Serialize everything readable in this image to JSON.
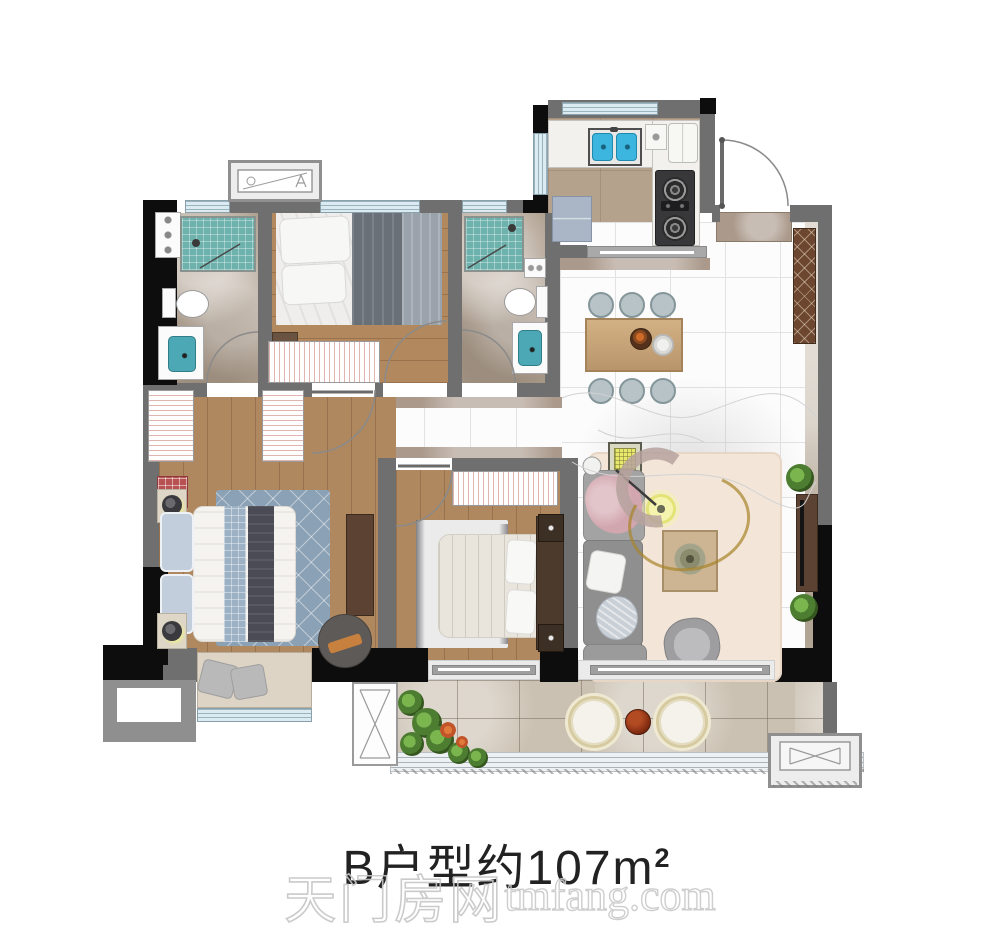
{
  "title": {
    "text": "B户型约107m",
    "sup": "2"
  },
  "watermark": {
    "cn": "天门房网",
    "en": "tmfang.com"
  },
  "palette": {
    "wall_gray": "#6f6f6f",
    "wall_black": "#0d0d0d",
    "window_blue": "#dcebf1",
    "window_line": "#9ab4be",
    "wood_floor": "#b0885f",
    "bath_marble": "#b0a191",
    "white_tile": "#fcfcfc",
    "balcony_tile": "#cbc1b2",
    "shower_teal": "#6db2ac",
    "fixture_teal": "#4ba8b4",
    "kitchen_sink_blue": "#3cb6de",
    "dining_wood": "#b9956b",
    "cabinet_walnut": "#6d4630",
    "sofa_gray": "#8f8f90",
    "living_rug": "#f3e6d9",
    "master_rug": "#8ba1b5",
    "accent_yellow": "#e8e86c",
    "plant_green": "#4c7d30",
    "balcony_table_red": "#7e2a10",
    "title_color": "#222222",
    "watermark_color": "#c6c6c6"
  }
}
